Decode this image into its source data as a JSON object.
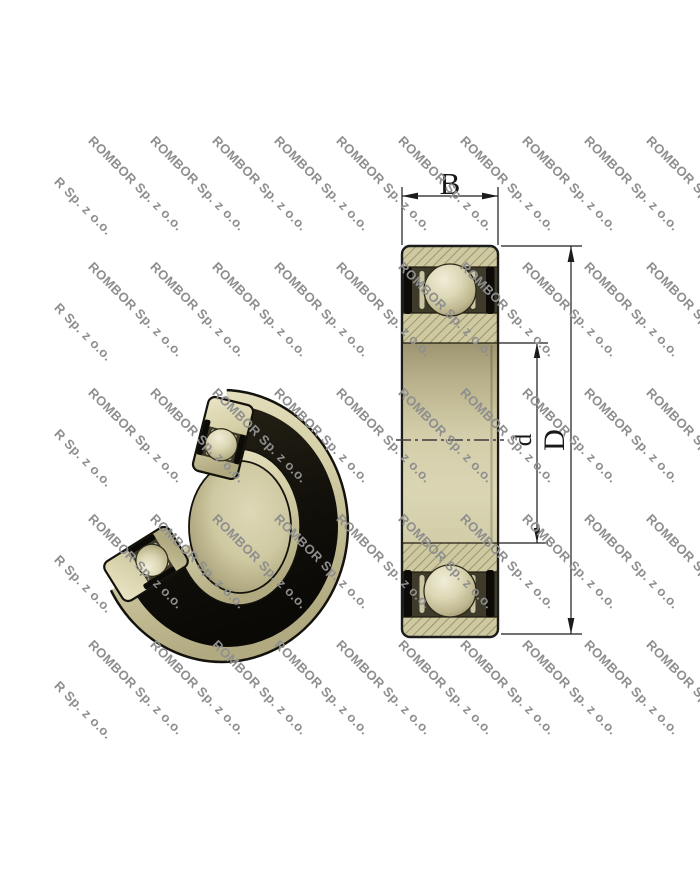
{
  "watermark": {
    "text": "ROMBOR Sp. z o.o.",
    "color": "#8e8e8e"
  },
  "drawing": {
    "labels": {
      "width": "B",
      "outer_diameter": "D",
      "bore_diameter": "d"
    }
  },
  "colors": {
    "body_tan": "#d6d0a8",
    "hatch_fill": "#cfc9a1",
    "hatch_line": "#8b855e",
    "raceway_dark": "#3e3b2a",
    "seal_black": "#0c0b07",
    "outline": "#1c1c1c"
  }
}
